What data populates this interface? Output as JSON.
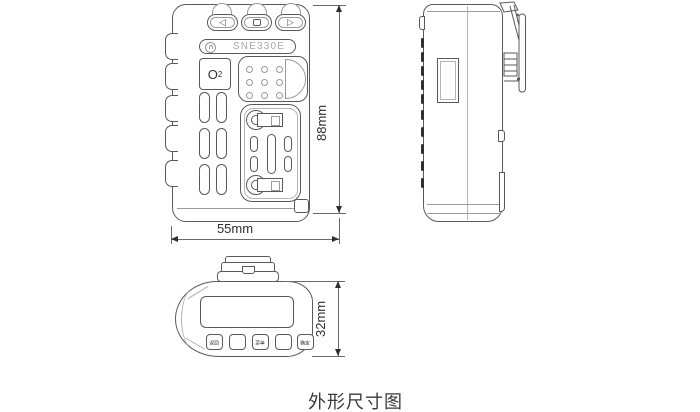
{
  "title_caption": "外形尺寸图",
  "colors": {
    "line": "#5a5a5a",
    "dark": "#2f2f2f",
    "muted": "#9a9a9a",
    "dim": "#6a6a6a",
    "text": "#3a3a3a",
    "model": "#a8a8a8"
  },
  "front_view": {
    "model_label": "SNE330E",
    "sensor_label": {
      "element": "O",
      "subscript": "2"
    },
    "nav_buttons": [
      {
        "icon": "left-arrow",
        "glyph": "◁"
      },
      {
        "icon": "square",
        "glyph": ""
      },
      {
        "icon": "right-arrow",
        "glyph": "▷"
      }
    ],
    "width_dim": "55mm",
    "height_dim": "88mm"
  },
  "bottom_view": {
    "button_labels": [
      "返回",
      "",
      "菜单",
      "",
      "确定"
    ],
    "depth_dim": "32mm"
  }
}
